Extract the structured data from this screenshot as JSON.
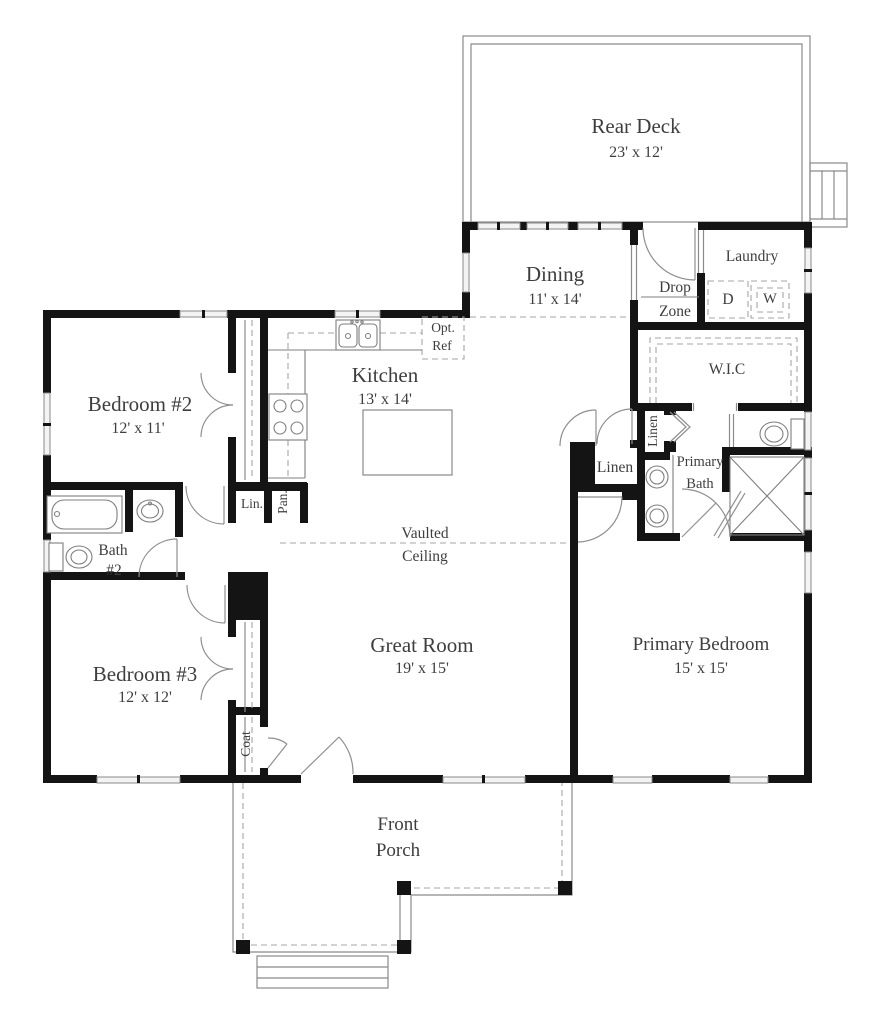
{
  "plan": {
    "rooms": {
      "rear_deck": {
        "name": "Rear Deck",
        "dims": "23' x 12'"
      },
      "dining": {
        "name": "Dining",
        "dims": "11' x 14'"
      },
      "laundry": {
        "name": "Laundry"
      },
      "drop_zone": {
        "line1": "Drop",
        "line2": "Zone"
      },
      "kitchen": {
        "name": "Kitchen",
        "dims": "13' x 14'"
      },
      "wic": {
        "name": "W.I.C"
      },
      "primary_bath": {
        "line1": "Primary",
        "line2": "Bath"
      },
      "bedroom2": {
        "name": "Bedroom #2",
        "dims": "12' x 11'"
      },
      "bath2": {
        "line1": "Bath",
        "line2": "#2"
      },
      "bedroom3": {
        "name": "Bedroom #3",
        "dims": "12' x 12'"
      },
      "great_room": {
        "name": "Great Room",
        "dims": "19' x 15'"
      },
      "primary_bedroom": {
        "name": "Primary Bedroom",
        "dims": "15' x 15'"
      },
      "front_porch": {
        "line1": "Front",
        "line2": "Porch"
      }
    },
    "closets": {
      "linen_hall": "Linen",
      "linen_bath": "Linen",
      "linen_small": "Lin.",
      "pantry": "Pan.",
      "coat": "Coat"
    },
    "appliances": {
      "dryer": "D",
      "washer": "W",
      "opt_ref_line1": "Opt.",
      "opt_ref_line2": "Ref"
    },
    "annotations": {
      "vaulted_line1": "Vaulted",
      "vaulted_line2": "Ceiling"
    },
    "colors": {
      "wall": "#141414",
      "thin_line": "#8a8a8a",
      "dashed_line": "#a6a6a6",
      "text": "#3e3e3e",
      "window_fill": "#f3f3f3",
      "background": "#ffffff"
    }
  }
}
